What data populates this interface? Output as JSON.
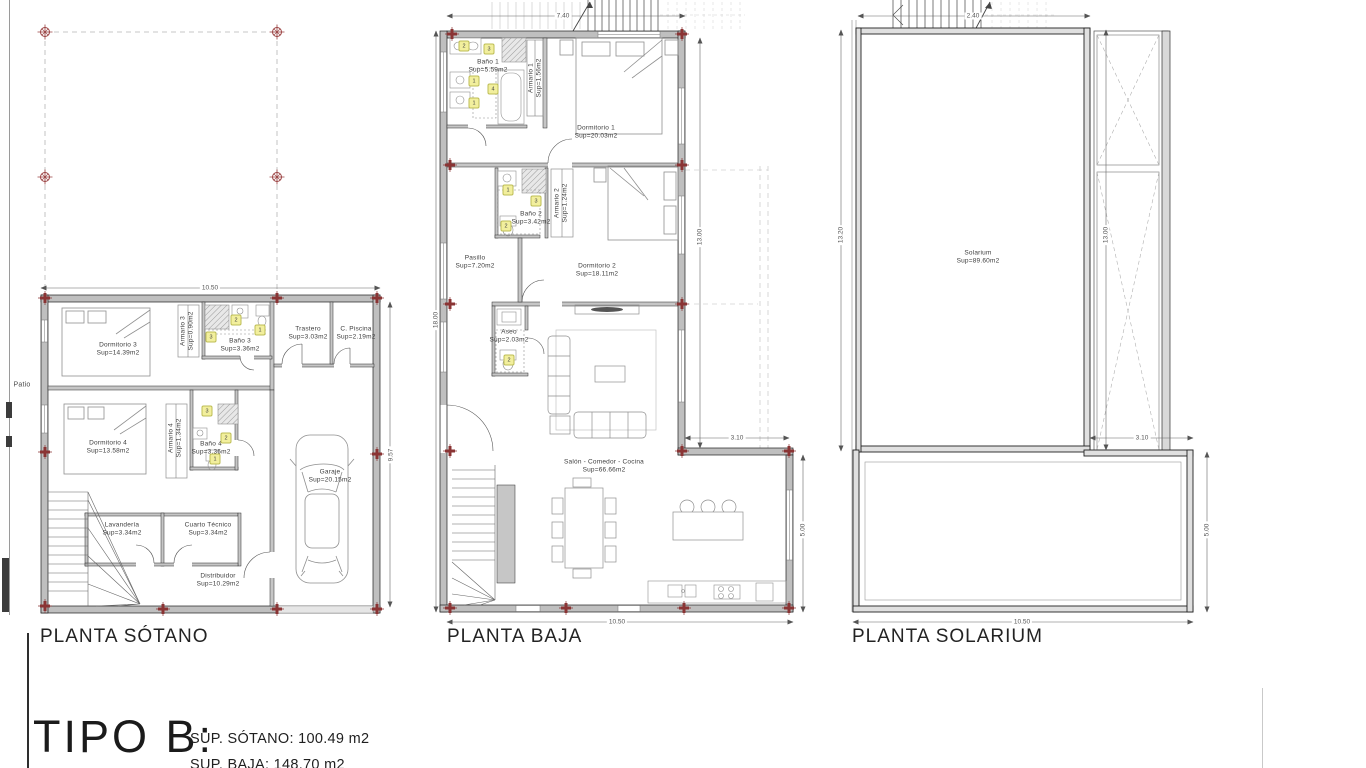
{
  "title_block": {
    "model": "TIPO B:",
    "areas": [
      "SUP. SÓTANO: 100.49 m2",
      "SUP. BAJA: 148.70 m2"
    ]
  },
  "plans": {
    "sotano": {
      "title": "PLANTA SÓTANO",
      "patio": "Patio",
      "rooms": [
        {
          "name": "Dormitorio 3",
          "sup": "Sup=14.39m2"
        },
        {
          "name": "Armario 3",
          "sup": "Sup=0.90m2"
        },
        {
          "name": "Baño 3",
          "sup": "Sup=3.36m2"
        },
        {
          "name": "Trastero",
          "sup": "Sup=3.03m2"
        },
        {
          "name": "C. Piscina",
          "sup": "Sup=2.19m2"
        },
        {
          "name": "Dormitorio 4",
          "sup": "Sup=13.58m2"
        },
        {
          "name": "Armario 4",
          "sup": "Sup=1.34m2"
        },
        {
          "name": "Baño 4",
          "sup": "Sup=3.36m2"
        },
        {
          "name": "Garaje",
          "sup": "Sup=20.15m2"
        },
        {
          "name": "Lavandería",
          "sup": "Sup=3.34m2"
        },
        {
          "name": "Cuarto Técnico",
          "sup": "Sup=3.34m2"
        },
        {
          "name": "Distribuidor",
          "sup": "Sup=10.29m2"
        }
      ],
      "fixtures": [
        "3",
        "2",
        "1",
        "3",
        "2",
        "1"
      ],
      "dims": {
        "top": "10.50",
        "right": "9.57"
      }
    },
    "baja": {
      "title": "PLANTA BAJA",
      "rooms": [
        {
          "name": "Baño 1",
          "sup": "Sup=5.59m2"
        },
        {
          "name": "Armario 1",
          "sup": "Sup=1.56m2"
        },
        {
          "name": "Dormitorio 1",
          "sup": "Sup=20.03m2"
        },
        {
          "name": "Baño 2",
          "sup": "Sup=3.42m2"
        },
        {
          "name": "Armario 2",
          "sup": "Sup=1.24m2"
        },
        {
          "name": "Dormitorio 2",
          "sup": "Sup=18.11m2"
        },
        {
          "name": "Pasillo",
          "sup": "Sup=7.20m2"
        },
        {
          "name": "Aseo",
          "sup": "Sup=2.03m2"
        },
        {
          "name": "Salón - Comedor - Cocina",
          "sup": "Sup=66.66m2"
        }
      ],
      "fixtures": [
        "2",
        "3",
        "1",
        "4",
        "1",
        "1",
        "3",
        "2",
        "2"
      ],
      "dims": {
        "top": "7.40",
        "left": "18.00",
        "right_upper": "13.00",
        "step": "3.10",
        "right_lower": "5.00",
        "bottom": "10.50"
      }
    },
    "solarium": {
      "title": "PLANTA SOLARIUM",
      "rooms": [
        {
          "name": "Solarium",
          "sup": "Sup=89.60m2"
        }
      ],
      "dims": {
        "top": "2.40",
        "left": "13.20",
        "right_upper": "13.00",
        "step": "3.10",
        "right_lower": "5.00",
        "bottom": "10.50"
      }
    }
  },
  "colors": {
    "marker_red": "#8a3434",
    "chip_yellow": "#f2ef9d",
    "wall_gray": "#bfbfbf"
  }
}
